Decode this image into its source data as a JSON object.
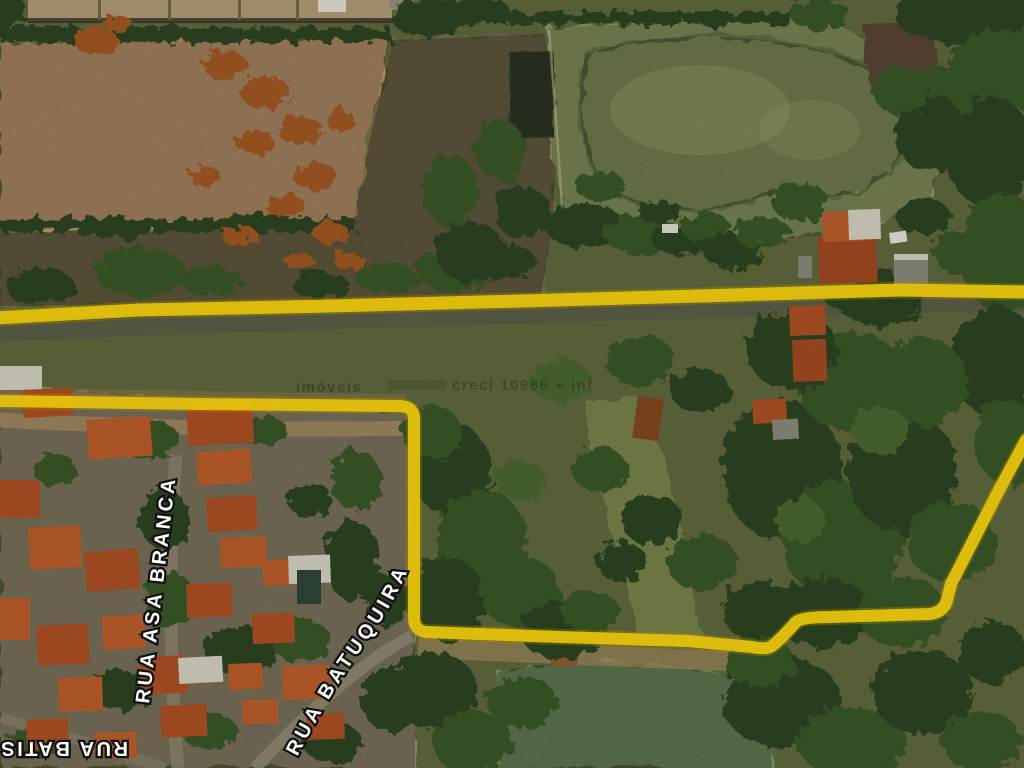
{
  "map": {
    "kind": "satellite-aerial-photo",
    "overlay": "yellow hand-drawn property boundary and road highlight"
  },
  "labels": {
    "asa_branca": "RUA ASA BRANCA",
    "batuquira": "RUA BATUQUIRA",
    "batis": "RUA BATIS"
  },
  "watermark": {
    "left": "imóveis",
    "right": "creci 10986 + inf"
  },
  "colors": {
    "base": "#6e7a47",
    "field_olive": "#7b7450",
    "field_pink": "#c79e73",
    "field_green": "#8f9e66",
    "pond": "#8c9a62",
    "minipond": "#3e4c30",
    "bottom_pond": "#7fa06a",
    "residential": "#9c9274",
    "road_grey": "#5d6149",
    "dirt_road": "#a98f62",
    "tree_dark": "#2f4721",
    "tree_mid": "#3d5a2a",
    "tree_light": "#4e6c33",
    "rust": "#a85c28",
    "roof": "#b35426",
    "roof_bright": "#c2622e",
    "white_roof": "#ddd8c8",
    "grey_shed": "#90907f",
    "barn": "#b7a17b",
    "brown_patch": "#5c4734",
    "boundary_yellow": "#e7c30c",
    "boundary_edge": "#a98a00",
    "label_white": "#ffffff",
    "label_stroke": "#101010",
    "watermark": "#20261a"
  }
}
